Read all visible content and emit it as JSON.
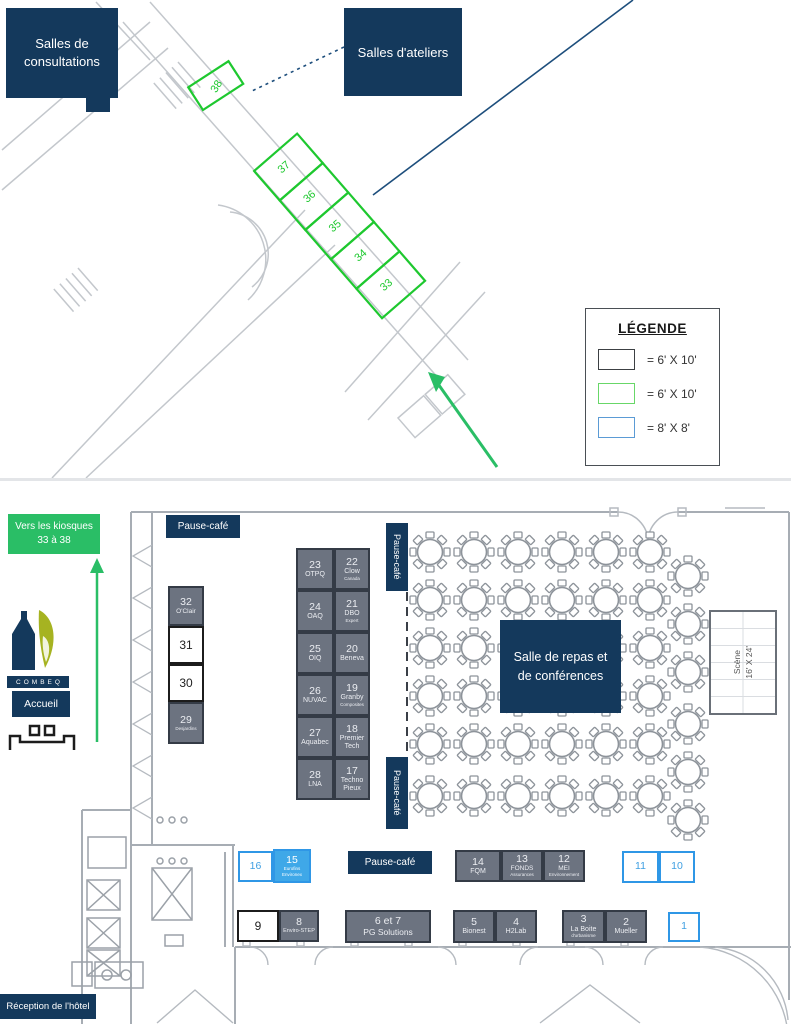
{
  "colors": {
    "navy": "#14395c",
    "green_accent": "#2abe66",
    "kiosk_green_outline": "#1ec82f",
    "kiosk_blue_outline": "#2f97e6",
    "kiosk_blue_fill": "#3fa8e8",
    "kiosk_gray_fill": "#6c7380"
  },
  "top_plan": {
    "consultations_label": "Salles de consultations",
    "ateliers_label": "Salles d'ateliers",
    "legend": {
      "title": "LÉGENDE",
      "items": [
        {
          "swatch": "black-outline-box",
          "label": "= 6' X 10'"
        },
        {
          "swatch": "green-outline-box",
          "label": "= 6' X 10'"
        },
        {
          "swatch": "blue-outline-box",
          "label": "= 8' X 8'"
        }
      ]
    },
    "green_kiosks": [
      "38",
      "37",
      "36",
      "35",
      "34",
      "33"
    ]
  },
  "hall": {
    "direction_sign": {
      "line1": "Vers les kiosques",
      "line2": "33 à 38"
    },
    "brand": "COMBEQ",
    "accueil_label": "Accueil",
    "reception_label": "Réception de l'hôtel",
    "pause_cafe": {
      "north": "Pause-café",
      "east_upper": "Pause-café",
      "east_lower": "Pause-café",
      "south": "Pause-café"
    },
    "dining_room": {
      "line1": "Salle de repas et",
      "line2": "de conférences"
    },
    "stage": {
      "name": "Scène",
      "size": "16' X 24'"
    }
  },
  "kiosks": {
    "west": [
      {
        "num": "32",
        "name": "O'Clair"
      },
      {
        "num": "31",
        "name": ""
      },
      {
        "num": "30",
        "name": ""
      },
      {
        "num": "29",
        "name": "Desjardins"
      }
    ],
    "center_left": [
      {
        "num": "23",
        "name": "OTPQ"
      },
      {
        "num": "24",
        "name": "OAQ"
      },
      {
        "num": "25",
        "name": "OIQ"
      },
      {
        "num": "26",
        "name": "NUVAC"
      },
      {
        "num": "27",
        "name": "Aquabec"
      },
      {
        "num": "28",
        "name": "LNA"
      }
    ],
    "center_right": [
      {
        "num": "22",
        "name": "Clow",
        "sub": "Canada"
      },
      {
        "num": "21",
        "name": "DBO",
        "sub": "Expert"
      },
      {
        "num": "20",
        "name": "Beneva",
        "sub": ""
      },
      {
        "num": "19",
        "name": "Granby",
        "sub": "Composites"
      },
      {
        "num": "18",
        "name": "Premier Tech",
        "sub": ""
      },
      {
        "num": "17",
        "name": "Techno Pieux",
        "sub": ""
      }
    ],
    "south_upper": [
      {
        "num": "16",
        "name": ""
      },
      {
        "num": "15",
        "name": "Eurofins",
        "sub": "Environex"
      },
      {
        "num": "14",
        "name": "FQM"
      },
      {
        "num": "13",
        "name": "FONDS",
        "sub": "Assurances"
      },
      {
        "num": "12",
        "name": "MEI",
        "sub": "Environnement"
      },
      {
        "num": "11",
        "name": ""
      },
      {
        "num": "10",
        "name": ""
      }
    ],
    "south_lower": [
      {
        "num": "9",
        "name": ""
      },
      {
        "num": "8",
        "name": "Enviro-STEP"
      },
      {
        "num": "6 et 7",
        "name": "PG Solutions"
      },
      {
        "num": "5",
        "name": "Bionest"
      },
      {
        "num": "4",
        "name": "H2Lab"
      },
      {
        "num": "3",
        "name": "La Boite",
        "sub": "d'urbanisme"
      },
      {
        "num": "2",
        "name": "Mueller"
      },
      {
        "num": "1",
        "name": ""
      }
    ]
  }
}
